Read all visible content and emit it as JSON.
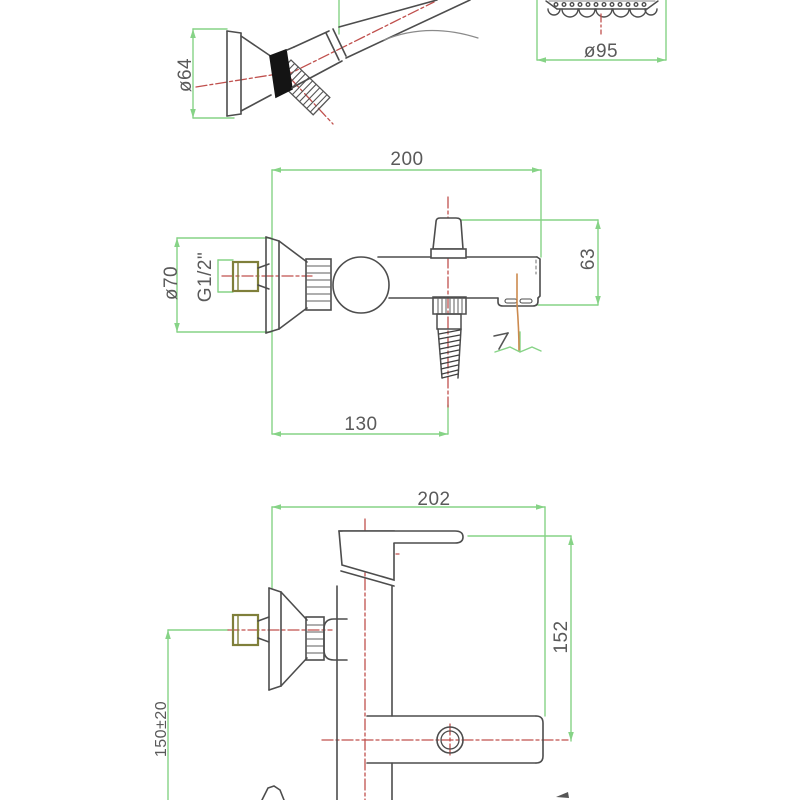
{
  "colors": {
    "dimension_green": "#86d386",
    "centerline_red": "#c0504d",
    "outline_gray": "#4d4d4d",
    "thread_olive": "#7f7f3a",
    "water_orange": "#cc8a4e",
    "ring_black": "#141414",
    "background": "#ffffff"
  },
  "views": {
    "handshower": {
      "diameter_label": "ø64"
    },
    "showerhead": {
      "diameter_label": "ø95"
    },
    "bath_mixer": {
      "width_label": "200",
      "spout_depth_label": "130",
      "flange_label": "ø70",
      "thread_label": "G1/2\"",
      "spout_height_label": "63"
    },
    "shower_mixer": {
      "width_label": "202",
      "height_label": "152",
      "install_height_label": "150±20"
    }
  }
}
